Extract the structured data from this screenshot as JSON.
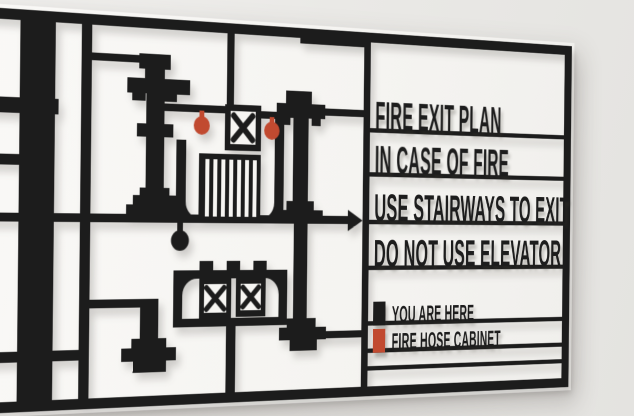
{
  "sign": {
    "messages": {
      "line1": "FIRE EXIT PLAN",
      "line2": "IN CASE OF FIRE",
      "line3": "USE STAIRWAYS TO EXIT",
      "line4": "DO NOT USE ELEVATOR"
    },
    "legend": {
      "you_are_here": {
        "label": "YOU ARE HERE",
        "marker": "black-pin"
      },
      "fire_hose": {
        "label": "FIRE HOSE CABINET",
        "marker": "red-pin"
      }
    },
    "plan_icons": {
      "stairs": "stair-treads-block",
      "elevators": "x-box",
      "exit_direction": "right-arrow",
      "you_are_here_dot": "black-ball-pin",
      "fire_hose_pins": "red-ball-pin"
    },
    "colors": {
      "sign_black": "#1c1c1c",
      "marker_red": "#c14a30",
      "wall": "#eae9e6",
      "sign_interior": "#f6f5f2"
    }
  }
}
